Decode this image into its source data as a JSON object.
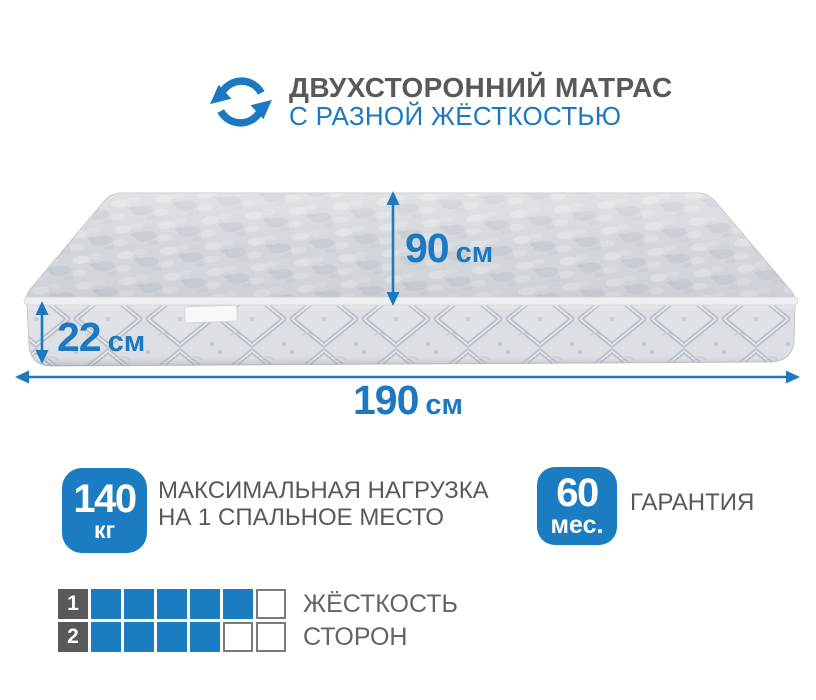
{
  "colors": {
    "accent_blue": "#1c78c0",
    "badge_blue": "#1c7cc2",
    "text_gray": "#58595b",
    "mattress_light": "#d3d6db",
    "mattress_shadow": "#c2c7cf"
  },
  "header": {
    "icon": "rotating-arrows-icon",
    "title": "ДВУХСТОРОННИЙ МАТРАС",
    "subtitle": "С РАЗНОЙ ЖЁСТКОСТЬЮ"
  },
  "dimensions": {
    "depth": {
      "value": "90",
      "unit": "см"
    },
    "height": {
      "value": "22",
      "unit": "см"
    },
    "width": {
      "value": "190",
      "unit": "см"
    }
  },
  "badges": [
    {
      "value": "140",
      "unit": "кг",
      "label_line1": "МАКСИМАЛЬНАЯ НАГРУЗКА",
      "label_line2": "НА 1 СПАЛЬНОЕ МЕСТО"
    },
    {
      "value": "60",
      "unit": "мес.",
      "label_line1": "ГАРАНТИЯ",
      "label_line2": ""
    }
  ],
  "firmness": {
    "label_line1": "ЖЁСТКОСТЬ",
    "label_line2": "СТОРОН",
    "rows": [
      {
        "number": "1",
        "filled": 5,
        "total": 6
      },
      {
        "number": "2",
        "filled": 4,
        "total": 6
      }
    ]
  }
}
